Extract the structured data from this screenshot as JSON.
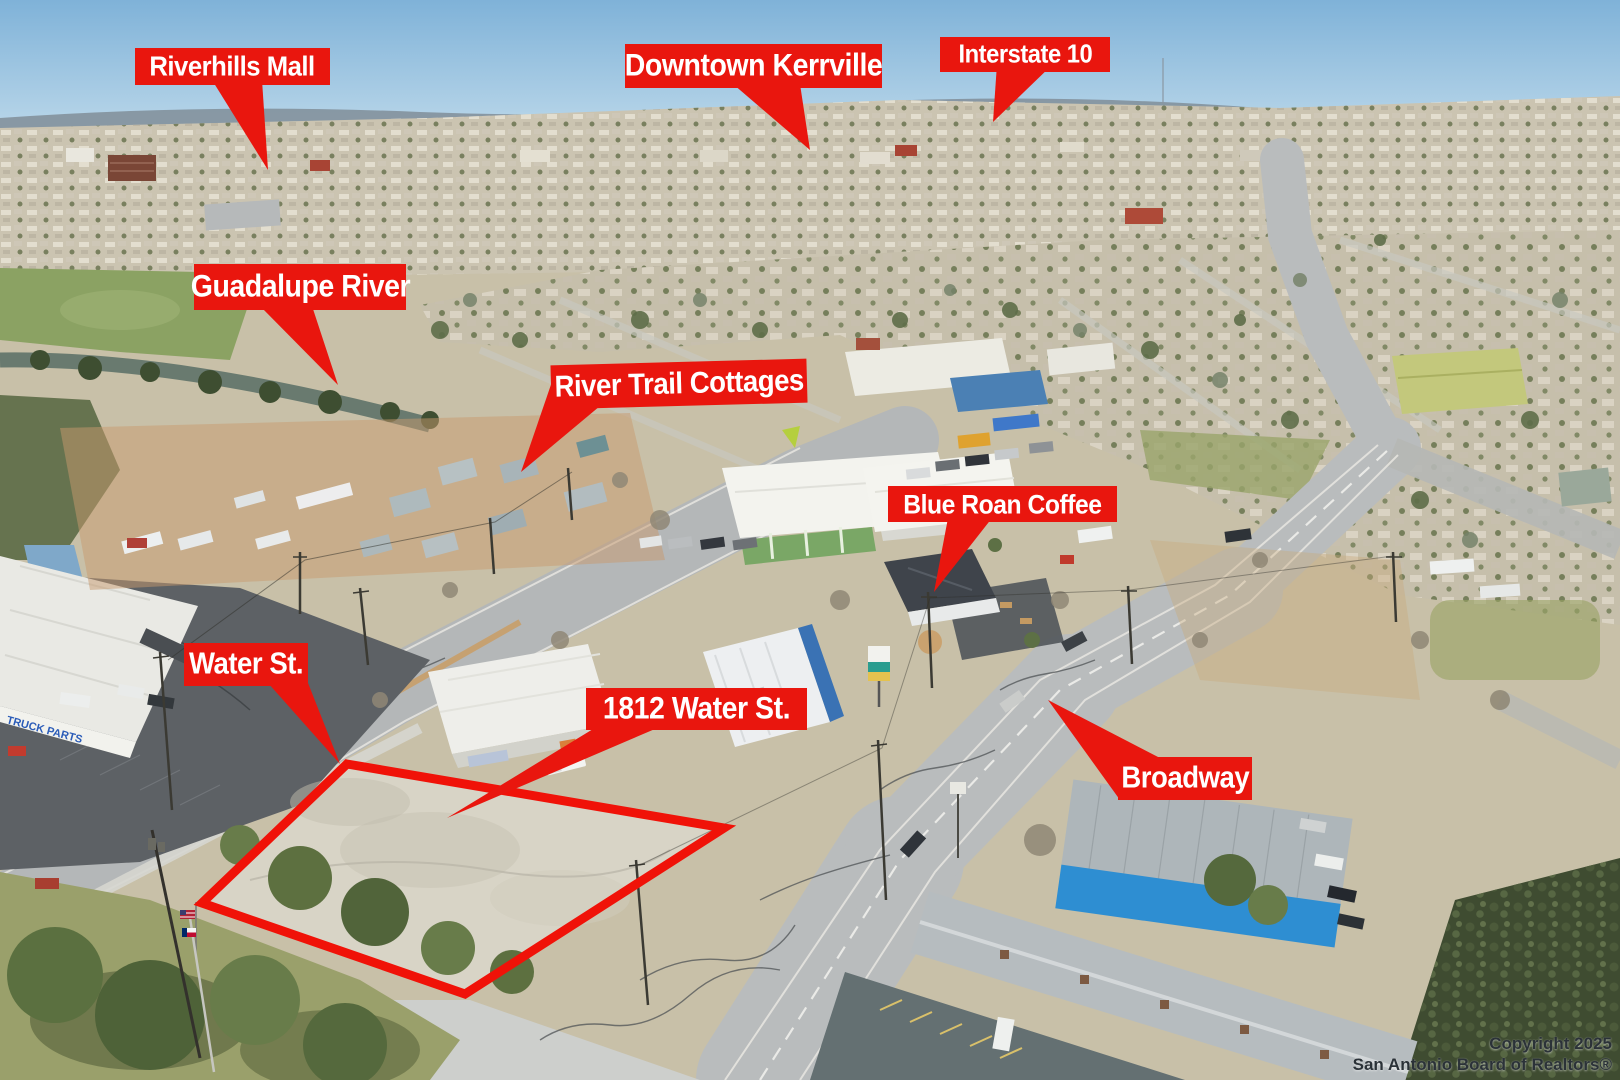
{
  "scene": {
    "description": "Aerial drone photo of a commercial corner lot and surrounding town",
    "callout_color": "#e9160e",
    "callout_text_color": "#ffffff",
    "outline_color": "#f01208"
  },
  "callouts": [
    {
      "id": "riverhills-mall",
      "label": "Riverhills Mall"
    },
    {
      "id": "downtown-kerrville",
      "label": "Downtown Kerrville"
    },
    {
      "id": "interstate-10",
      "label": "Interstate 10"
    },
    {
      "id": "guadalupe-river",
      "label": "Guadalupe River"
    },
    {
      "id": "river-trail-cottages",
      "label": "River Trail Cottages"
    },
    {
      "id": "blue-roan-coffee",
      "label": "Blue Roan Coffee"
    },
    {
      "id": "water-st",
      "label": "Water St."
    },
    {
      "id": "address-1812-water-st",
      "label": "1812 Water St."
    },
    {
      "id": "broadway",
      "label": "Broadway"
    }
  ],
  "property_outline": {
    "label": "Subject property boundary"
  },
  "background_text": {
    "building_sign": "TRUCK PARTS"
  },
  "watermark": {
    "line1": "Copyright 2025",
    "line2": "San Antonio Board of Realtors®"
  }
}
